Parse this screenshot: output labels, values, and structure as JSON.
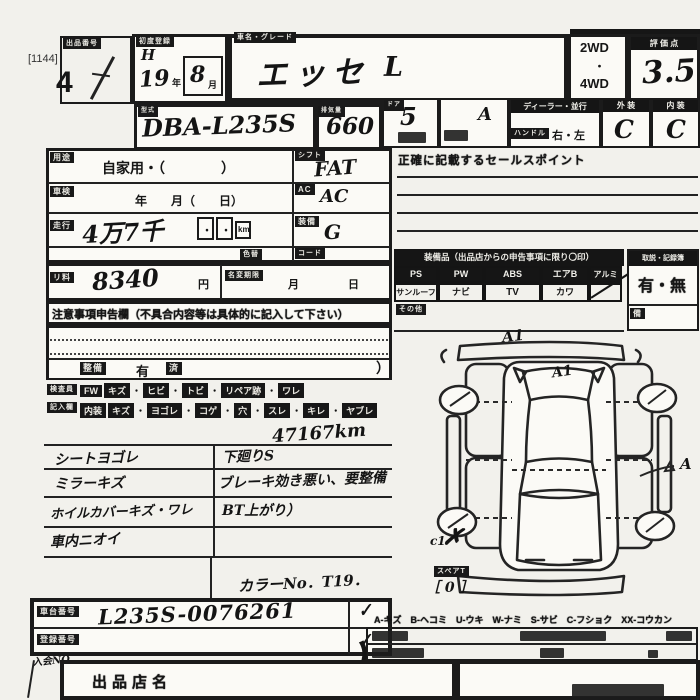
{
  "top": {
    "print_ref": "[1144]",
    "lot_label": "出品番号",
    "lot_no": "4"
  },
  "header": {
    "reg_label": "初度登録",
    "reg_era": "H",
    "reg_year": "19",
    "reg_year_unit": "年",
    "reg_month": "8",
    "reg_month_unit": "月",
    "name_label": "車名・グレード",
    "car_name": "エッセ",
    "grade": "L",
    "drive_top": "2WD",
    "drive_dot": "・",
    "drive_bottom": "4WD",
    "score_label": "評 価 点",
    "score": "3.5",
    "model_label": "型式",
    "model_code": "DBA-L235S",
    "disp_label": "排気量",
    "displacement": "660",
    "doors_label": "ドア",
    "doors": "5",
    "capacity_label": "定員",
    "capacity": "A",
    "dealer_label": "ディーラー・並行",
    "handle_label": "ハンドル",
    "handle_value": "右・左",
    "ext_label": "外 装",
    "ext_grade": "C",
    "int_label": "内 装",
    "int_grade": "C",
    "sales_banner": "正確に記載するセールスポイント"
  },
  "left": {
    "usage_label": "用途",
    "usage": "自家用・（　　　　）",
    "shaken_label": "車検",
    "shaken": "年　　月（　　日）",
    "shift_label": "シフト",
    "shift": "FAT",
    "ac_label": "AC",
    "ac": "AC",
    "mileage_label": "走行",
    "mileage": "4万7千",
    "dot1": "・",
    "dot2": "・",
    "mileage_unit": "km",
    "equip_label": "装備",
    "equip": "G",
    "colorchg_label": "色替",
    "code_label": "コード",
    "recycle_label": "リ料",
    "recycle": "8340",
    "recycle_unit": "円",
    "namechg_label": "名変期限",
    "namechg_month": "月",
    "namechg_day": "日",
    "notice_banner": "注意事項申告欄（不具合内容等は具体的に記入して下さい）",
    "repair_label": "整備",
    "repair_value": "有",
    "repair_value2": "済",
    "repair_close": "）"
  },
  "inspector": {
    "label1": "検査員",
    "label2": "記入欄",
    "sep": "・",
    "fw_label": "FW",
    "fw_items": [
      "キズ",
      "ヒビ",
      "トビ",
      "リペア跡",
      "ワレ"
    ],
    "int_label": "内装",
    "int_items": [
      "キズ",
      "ヨゴレ",
      "コゲ",
      "穴",
      "スレ",
      "キレ",
      "ヤブレ"
    ]
  },
  "notes": {
    "mileage": "47167km",
    "rows": [
      {
        "left": "シートヨゴレ",
        "right": "下廻りS"
      },
      {
        "left": "ミラーキズ",
        "right": "ブレーキ効き悪い、要整備"
      },
      {
        "left": "ホイルカバーキズ・ワレ",
        "right": "BT上がり）"
      },
      {
        "left": "車内ニオイ",
        "right": ""
      }
    ],
    "color_no": "カラーNo．T19．"
  },
  "equipment": {
    "header": "装備品（出品店からの申告事項に限り〇印）",
    "row1": [
      "PS",
      "PW",
      "ABS",
      "エアB",
      "アルミ"
    ],
    "row2": [
      "サンルーフ",
      "ナビ",
      "TV",
      "カワ",
      ""
    ],
    "slash": "／",
    "other_label": "その他",
    "right_header": "取説・記録簿",
    "right_value": "有・無",
    "right_note": "備"
  },
  "diagram": {
    "mark_front": "A1",
    "mark_glass": "A1",
    "mark_side": "A",
    "mark_corner": "c1",
    "spare_label": "スペアT",
    "spare_value": "［ 0 ］"
  },
  "legend": "A-キズ　B-ヘコミ　U-ウキ　W-ナミ　S-サビ　C-フショク　XX-コウカン",
  "bottom": {
    "chassis_label": "車台番号",
    "chassis": "L235S-0076261",
    "reg_label": "登録番号",
    "reg": "",
    "exhibitor_label": "出品店名"
  },
  "misc": {
    "check": "✓",
    "cross": "✗",
    "bracket": "）",
    "member_mark": "入会NO"
  }
}
